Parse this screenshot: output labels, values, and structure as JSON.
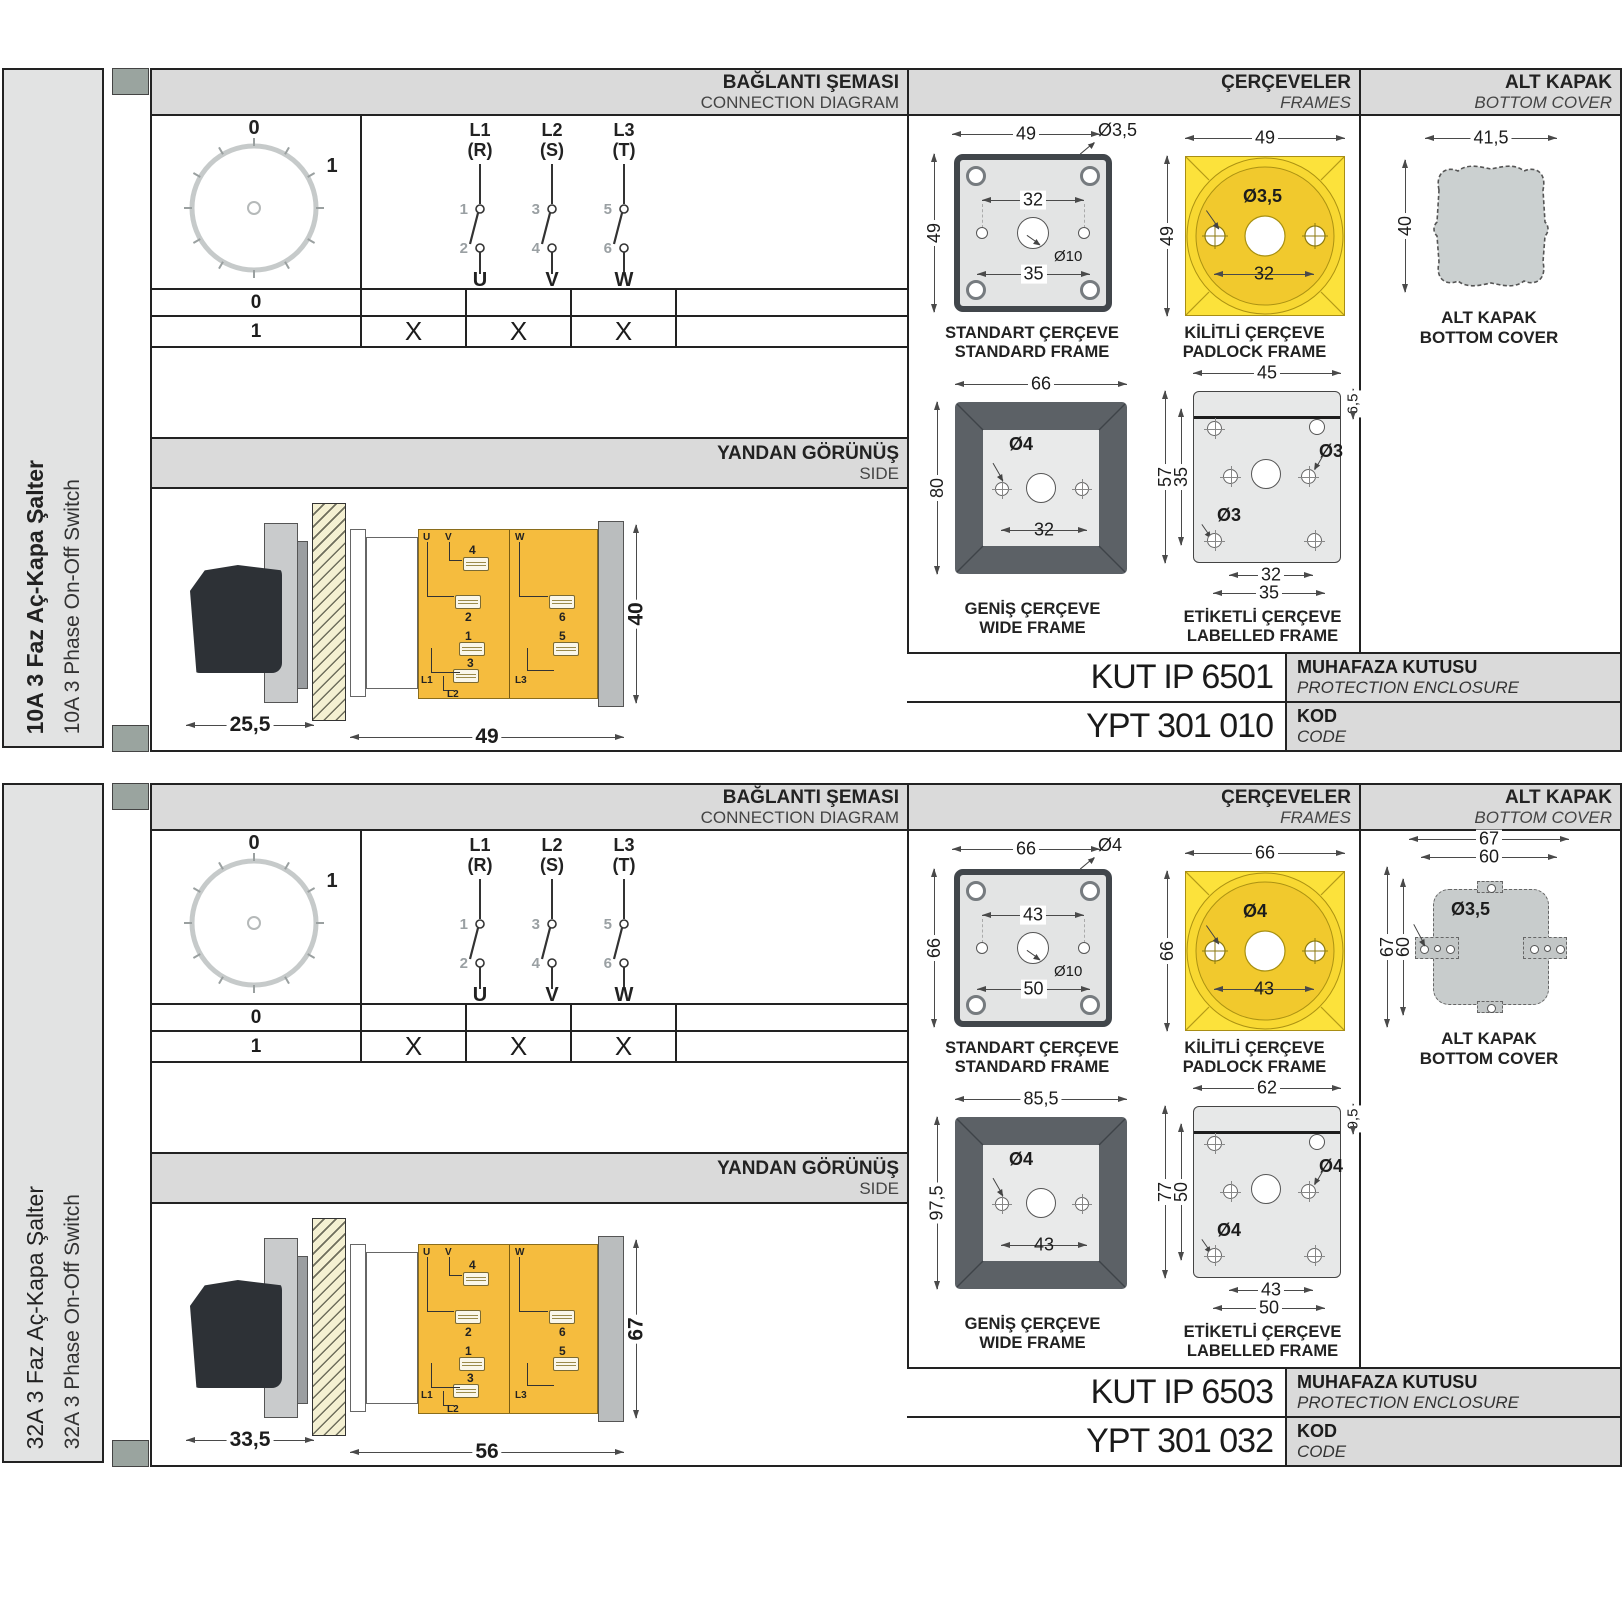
{
  "colors": {
    "accent_yellow": "#f5bc3e",
    "padlock_yellow": "#fce23b",
    "band_gray": "#dadada",
    "line_black": "#222222"
  },
  "sections": [
    {
      "sidebar": {
        "title_tr": "10A 3 Faz Aç-Kapa Şalter",
        "title_en": "10A 3 Phase On-Off Switch"
      },
      "headers": {
        "connection_tr": "BAĞLANTI ŞEMASI",
        "connection_en": "CONNECTION DIAGRAM",
        "frames_tr": "ÇERÇEVELER",
        "frames_en": "FRAMES",
        "cover_tr": "ALT KAPAK",
        "cover_en": "BOTTOM COVER"
      },
      "dial": {
        "off": "0",
        "on": "1"
      },
      "phases": [
        {
          "supply": "L1",
          "phase": "(R)",
          "top": "1",
          "bottom": "2",
          "load": "U"
        },
        {
          "supply": "L2",
          "phase": "(S)",
          "top": "3",
          "bottom": "4",
          "load": "V"
        },
        {
          "supply": "L3",
          "phase": "(T)",
          "top": "5",
          "bottom": "6",
          "load": "W"
        }
      ],
      "table": {
        "rows": [
          {
            "position": "0",
            "u": "",
            "v": "",
            "w": ""
          },
          {
            "position": "1",
            "u": "X",
            "v": "X",
            "w": "X"
          }
        ]
      },
      "side": {
        "title_tr": "YANDAN GÖRÜNÜŞ",
        "title_en": "SIDE",
        "depth": "25,5",
        "width": "49",
        "height": "40",
        "labels": {
          "u": "U",
          "v": "V",
          "w": "W",
          "t1": "1",
          "t2": "2",
          "t3": "3",
          "t4": "4",
          "t5": "5",
          "t6": "6",
          "l1": "L1",
          "l2": "L2",
          "l3": "L3"
        }
      },
      "frames": {
        "std": {
          "caption_tr": "STANDART ÇERÇEVE",
          "caption_en": "STANDARD FRAME",
          "w": "49",
          "h": "49",
          "inner_top": "32",
          "inner_bottom": "35",
          "hole": "Ø3,5",
          "center": "Ø10"
        },
        "padlock": {
          "caption_tr": "KİLİTLİ ÇERÇEVE",
          "caption_en": "PADLOCK FRAME",
          "w": "49",
          "h": "49",
          "hole": "Ø3,5",
          "inner": "32"
        },
        "wide": {
          "caption_tr": "GENİŞ ÇERÇEVE",
          "caption_en": "WIDE FRAME",
          "w": "66",
          "h": "80",
          "hole": "Ø4",
          "inner": "32"
        },
        "labelled": {
          "caption_tr": "ETİKETLİ ÇERÇEVE",
          "caption_en": "LABELLED FRAME",
          "w": "45",
          "band": "6,5",
          "h": "57",
          "inner_h": "35",
          "hole_a": "Ø3",
          "hole_b": "Ø3",
          "inner_w": "32",
          "outer_w": "35"
        }
      },
      "cover": {
        "caption_tr": "ALT KAPAK",
        "caption_en": "BOTTOM COVER",
        "w": "41,5",
        "h": "40"
      },
      "codes": {
        "enclosure": "KUT IP 6501",
        "enclosure_tr": "MUHAFAZA KUTUSU",
        "enclosure_en": "PROTECTION ENCLOSURE",
        "code": "YPT 301 010",
        "code_tr": "KOD",
        "code_en": "CODE"
      }
    },
    {
      "sidebar": {
        "title_tr": "32A 3 Faz Aç-Kapa Şalter",
        "title_en": "32A 3 Phase On-Off Switch"
      },
      "headers": {
        "connection_tr": "BAĞLANTI ŞEMASI",
        "connection_en": "CONNECTION DIAGRAM",
        "frames_tr": "ÇERÇEVELER",
        "frames_en": "FRAMES",
        "cover_tr": "ALT KAPAK",
        "cover_en": "BOTTOM COVER"
      },
      "dial": {
        "off": "0",
        "on": "1"
      },
      "phases": [
        {
          "supply": "L1",
          "phase": "(R)",
          "top": "1",
          "bottom": "2",
          "load": "U"
        },
        {
          "supply": "L2",
          "phase": "(S)",
          "top": "3",
          "bottom": "4",
          "load": "V"
        },
        {
          "supply": "L3",
          "phase": "(T)",
          "top": "5",
          "bottom": "6",
          "load": "W"
        }
      ],
      "table": {
        "rows": [
          {
            "position": "0",
            "u": "",
            "v": "",
            "w": ""
          },
          {
            "position": "1",
            "u": "X",
            "v": "X",
            "w": "X"
          }
        ]
      },
      "side": {
        "title_tr": "YANDAN GÖRÜNÜŞ",
        "title_en": "SIDE",
        "depth": "33,5",
        "width": "56",
        "height": "67",
        "labels": {
          "u": "U",
          "v": "V",
          "w": "W",
          "t1": "1",
          "t2": "2",
          "t3": "3",
          "t4": "4",
          "t5": "5",
          "t6": "6",
          "l1": "L1",
          "l2": "L2",
          "l3": "L3"
        }
      },
      "frames": {
        "std": {
          "caption_tr": "STANDART ÇERÇEVE",
          "caption_en": "STANDARD FRAME",
          "w": "66",
          "h": "66",
          "inner_top": "43",
          "inner_bottom": "50",
          "hole": "Ø4",
          "center": "Ø10"
        },
        "padlock": {
          "caption_tr": "KİLİTLİ ÇERÇEVE",
          "caption_en": "PADLOCK FRAME",
          "w": "66",
          "h": "66",
          "hole": "Ø4",
          "inner": "43"
        },
        "wide": {
          "caption_tr": "GENİŞ ÇERÇEVE",
          "caption_en": "WIDE FRAME",
          "w": "85,5",
          "h": "97,5",
          "hole": "Ø4",
          "inner": "43"
        },
        "labelled": {
          "caption_tr": "ETİKETLİ ÇERÇEVE",
          "caption_en": "LABELLED FRAME",
          "w": "62",
          "band": "9,5",
          "h": "77",
          "inner_h": "50",
          "hole_a": "Ø4",
          "hole_b": "Ø4",
          "inner_w": "43",
          "outer_w": "50"
        }
      },
      "cover": {
        "caption_tr": "ALT KAPAK",
        "caption_en": "BOTTOM COVER",
        "w_outer": "67",
        "w_inner": "60",
        "h_outer": "67",
        "h_inner": "60",
        "hole": "Ø3,5"
      },
      "codes": {
        "enclosure": "KUT IP 6503",
        "enclosure_tr": "MUHAFAZA KUTUSU",
        "enclosure_en": "PROTECTION ENCLOSURE",
        "code": "YPT 301 032",
        "code_tr": "KOD",
        "code_en": "CODE"
      }
    }
  ]
}
